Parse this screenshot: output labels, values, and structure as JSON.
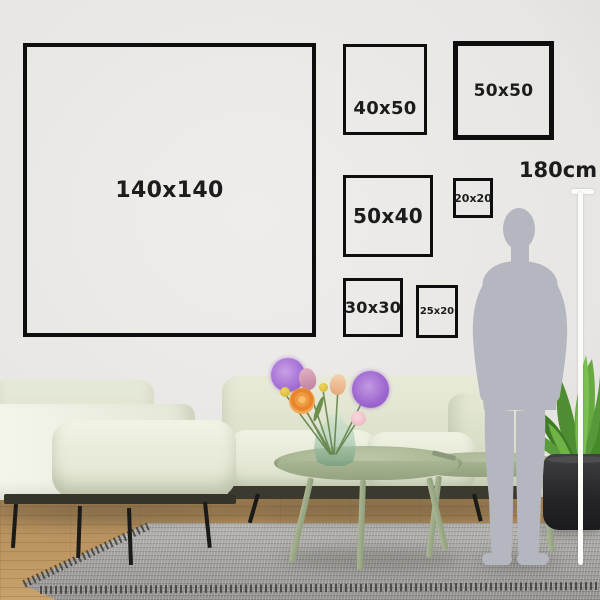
{
  "frames": [
    {
      "label": "140x140"
    },
    {
      "label": "40x50"
    },
    {
      "label": "50x50"
    },
    {
      "label": "50x40"
    },
    {
      "label": "20x20"
    },
    {
      "label": "30x30"
    },
    {
      "label": "25x20"
    }
  ],
  "scale": {
    "label": "180cm"
  },
  "colors": {
    "frame_border": "#0e0e0e",
    "label_text": "#1c1c1c",
    "wall": "#e9e7e4",
    "silhouette": "#b4b7c0",
    "measure_line": "#fbfbf8",
    "sofa": "#e4e8d4",
    "coffee_table": "#a9b693",
    "rug": "#a3a2a0",
    "wood_floor": "#bb955f",
    "plant_leaf": "#5ea23c",
    "plant_pot": "#252527",
    "flower_purple": "#a471d2",
    "flower_orange": "#ef9a3f",
    "flower_yellow": "#ddbf3a",
    "flower_pink": "#f2cbd2"
  }
}
